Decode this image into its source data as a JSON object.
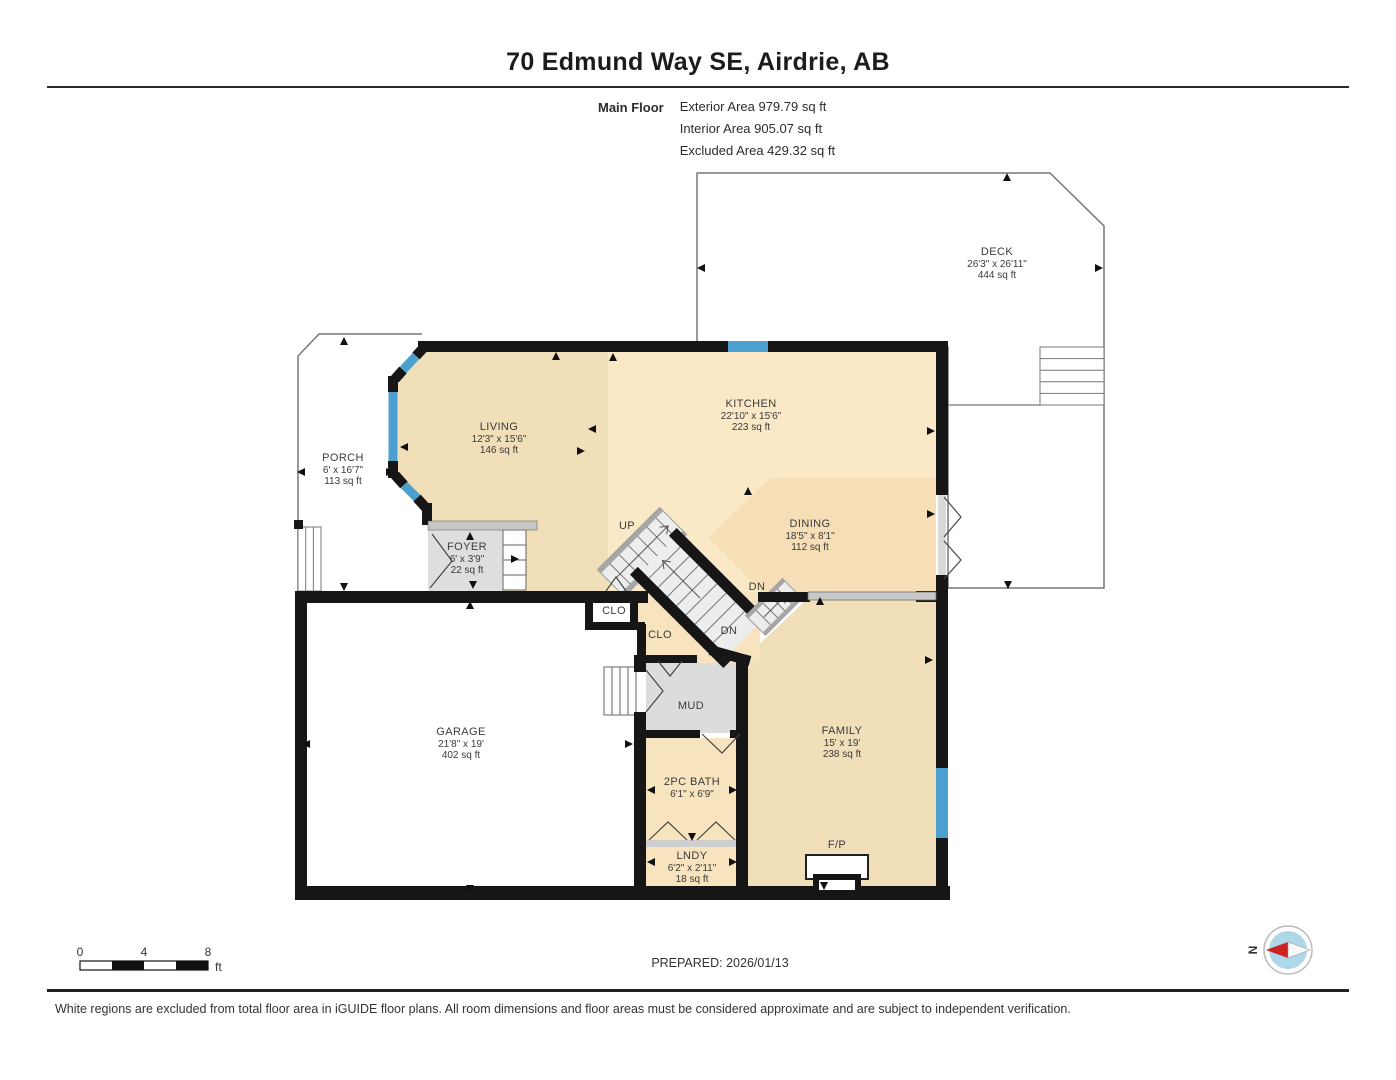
{
  "header": {
    "title": "70 Edmund Way SE, Airdrie, AB"
  },
  "summary": {
    "floor_label": "Main Floor",
    "areas": [
      "Exterior Area 979.79 sq ft",
      "Interior Area 905.07 sq ft",
      "Excluded Area 429.32 sq ft"
    ]
  },
  "rooms": [
    {
      "name": "DECK",
      "dims": "26'3\" x 26'11\"",
      "area": "444 sq ft"
    },
    {
      "name": "PORCH",
      "dims": "6' x 16'7\"",
      "area": "113 sq ft"
    },
    {
      "name": "LIVING",
      "dims": "12'3\" x 15'6\"",
      "area": "146 sq ft"
    },
    {
      "name": "KITCHEN",
      "dims": "22'10\" x 15'6\"",
      "area": "223 sq ft"
    },
    {
      "name": "DINING",
      "dims": "18'5\" x 8'1\"",
      "area": "112 sq ft"
    },
    {
      "name": "FOYER",
      "dims": "6' x 3'9\"",
      "area": "22 sq ft"
    },
    {
      "name": "GARAGE",
      "dims": "21'8\" x 19'",
      "area": "402 sq ft"
    },
    {
      "name": "FAMILY",
      "dims": "15' x 19'",
      "area": "238 sq ft"
    },
    {
      "name": "2PC BATH",
      "dims": "6'1\" x 6'9\"",
      "area": ""
    },
    {
      "name": "LNDY",
      "dims": "6'2\" x 2'11\"",
      "area": "18 sq ft"
    },
    {
      "name": "MUD"
    },
    {
      "name": "CLO"
    },
    {
      "name": "CLO"
    },
    {
      "name": "UP"
    },
    {
      "name": "DN"
    },
    {
      "name": "DN"
    },
    {
      "name": "F/P"
    }
  ],
  "scale_bar": {
    "t0": "0",
    "t1": "4",
    "t2": "8",
    "unit": "ft"
  },
  "compass": {
    "north_label": "N"
  },
  "footer": {
    "prepared": "PREPARED: 2026/01/13",
    "disclaimer": "White regions are excluded from total floor area in iGUIDE floor plans. All room dimensions and floor areas must be considered approximate and are subject to independent verification."
  },
  "colors": {
    "wall": "#161616",
    "window": "#4ba0d0",
    "floor_main": "#f7e3bd",
    "floor_gray": "#dedede",
    "excluded": "#ffffff"
  }
}
